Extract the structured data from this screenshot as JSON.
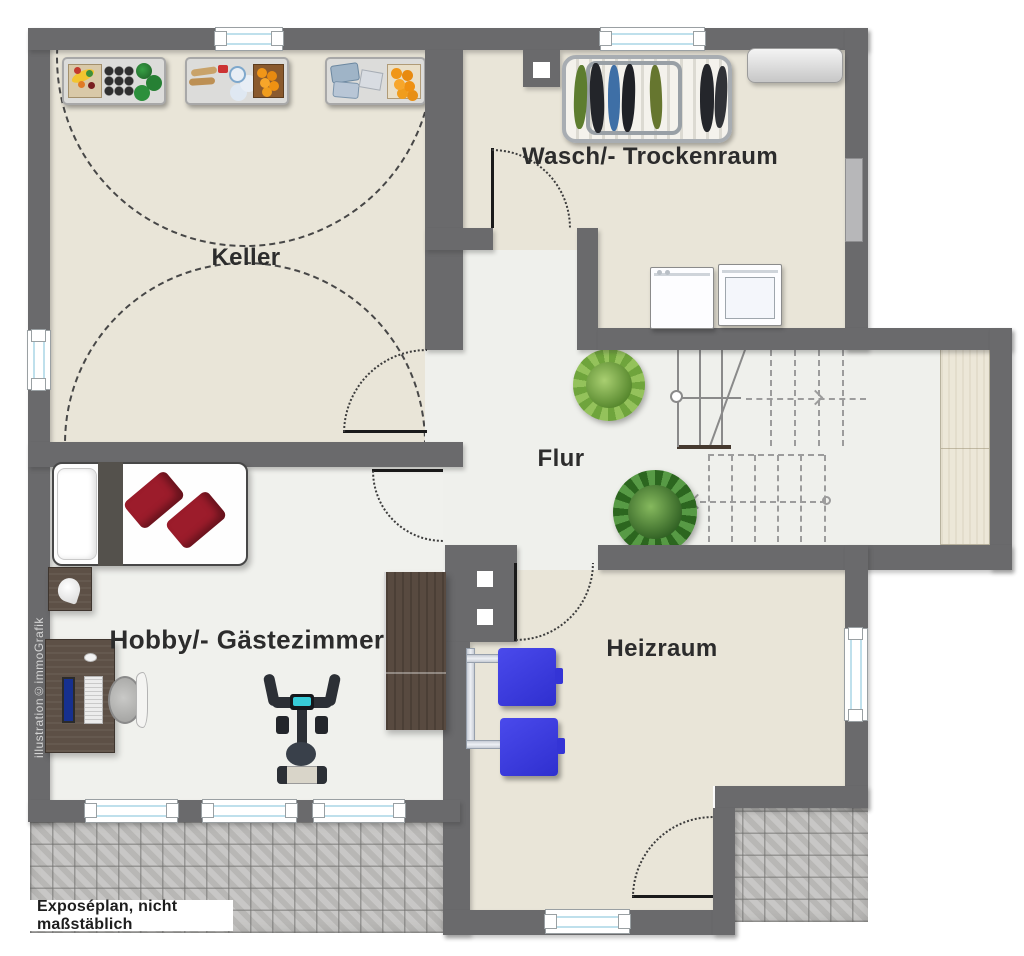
{
  "title": "Kellergeschoss Grundriss",
  "rooms": {
    "keller": {
      "label": "Keller"
    },
    "wasch": {
      "label": "Wasch/- Trockenraum"
    },
    "flur": {
      "label": "Flur"
    },
    "hobby": {
      "label": "Hobby/- Gästezimmer"
    },
    "heizraum": {
      "label": "Heizraum"
    }
  },
  "footer": {
    "note": "Exposéplan, nicht maßstäblich"
  },
  "watermark": {
    "text": "illustration©immoGrafik"
  },
  "colors": {
    "wall": "#6a6a6c",
    "floor_beige": "#e9e5d8",
    "floor_light": "#eff0ec",
    "paving": "#c2c1bf",
    "window_glass": "#bfe0ec",
    "tank_blue": "#3d3de2",
    "wood_dark": "#5d5046",
    "pillow_red": "#9c1c2b",
    "cabinet_cream": "#ece7d8"
  },
  "icons": {
    "keller": [
      "storage-shelf-icon",
      "storage-shelf-icon",
      "storage-shelf-icon"
    ],
    "wasch": [
      "drying-rack-icon",
      "countertop-icon",
      "washing-machine-icon",
      "dryer-icon",
      "exterior-door-icon"
    ],
    "flur": [
      "staircase-icon",
      "plant-icon",
      "plant-icon",
      "built-in-cabinet-icon"
    ],
    "hobby": [
      "bed-icon",
      "nightstand-icon",
      "desk-icon",
      "office-chair-icon",
      "exercise-bike-icon",
      "wardrobe-icon"
    ],
    "heizraum": [
      "heating-tank-icon",
      "heating-tank-icon",
      "chimney-icon"
    ]
  }
}
